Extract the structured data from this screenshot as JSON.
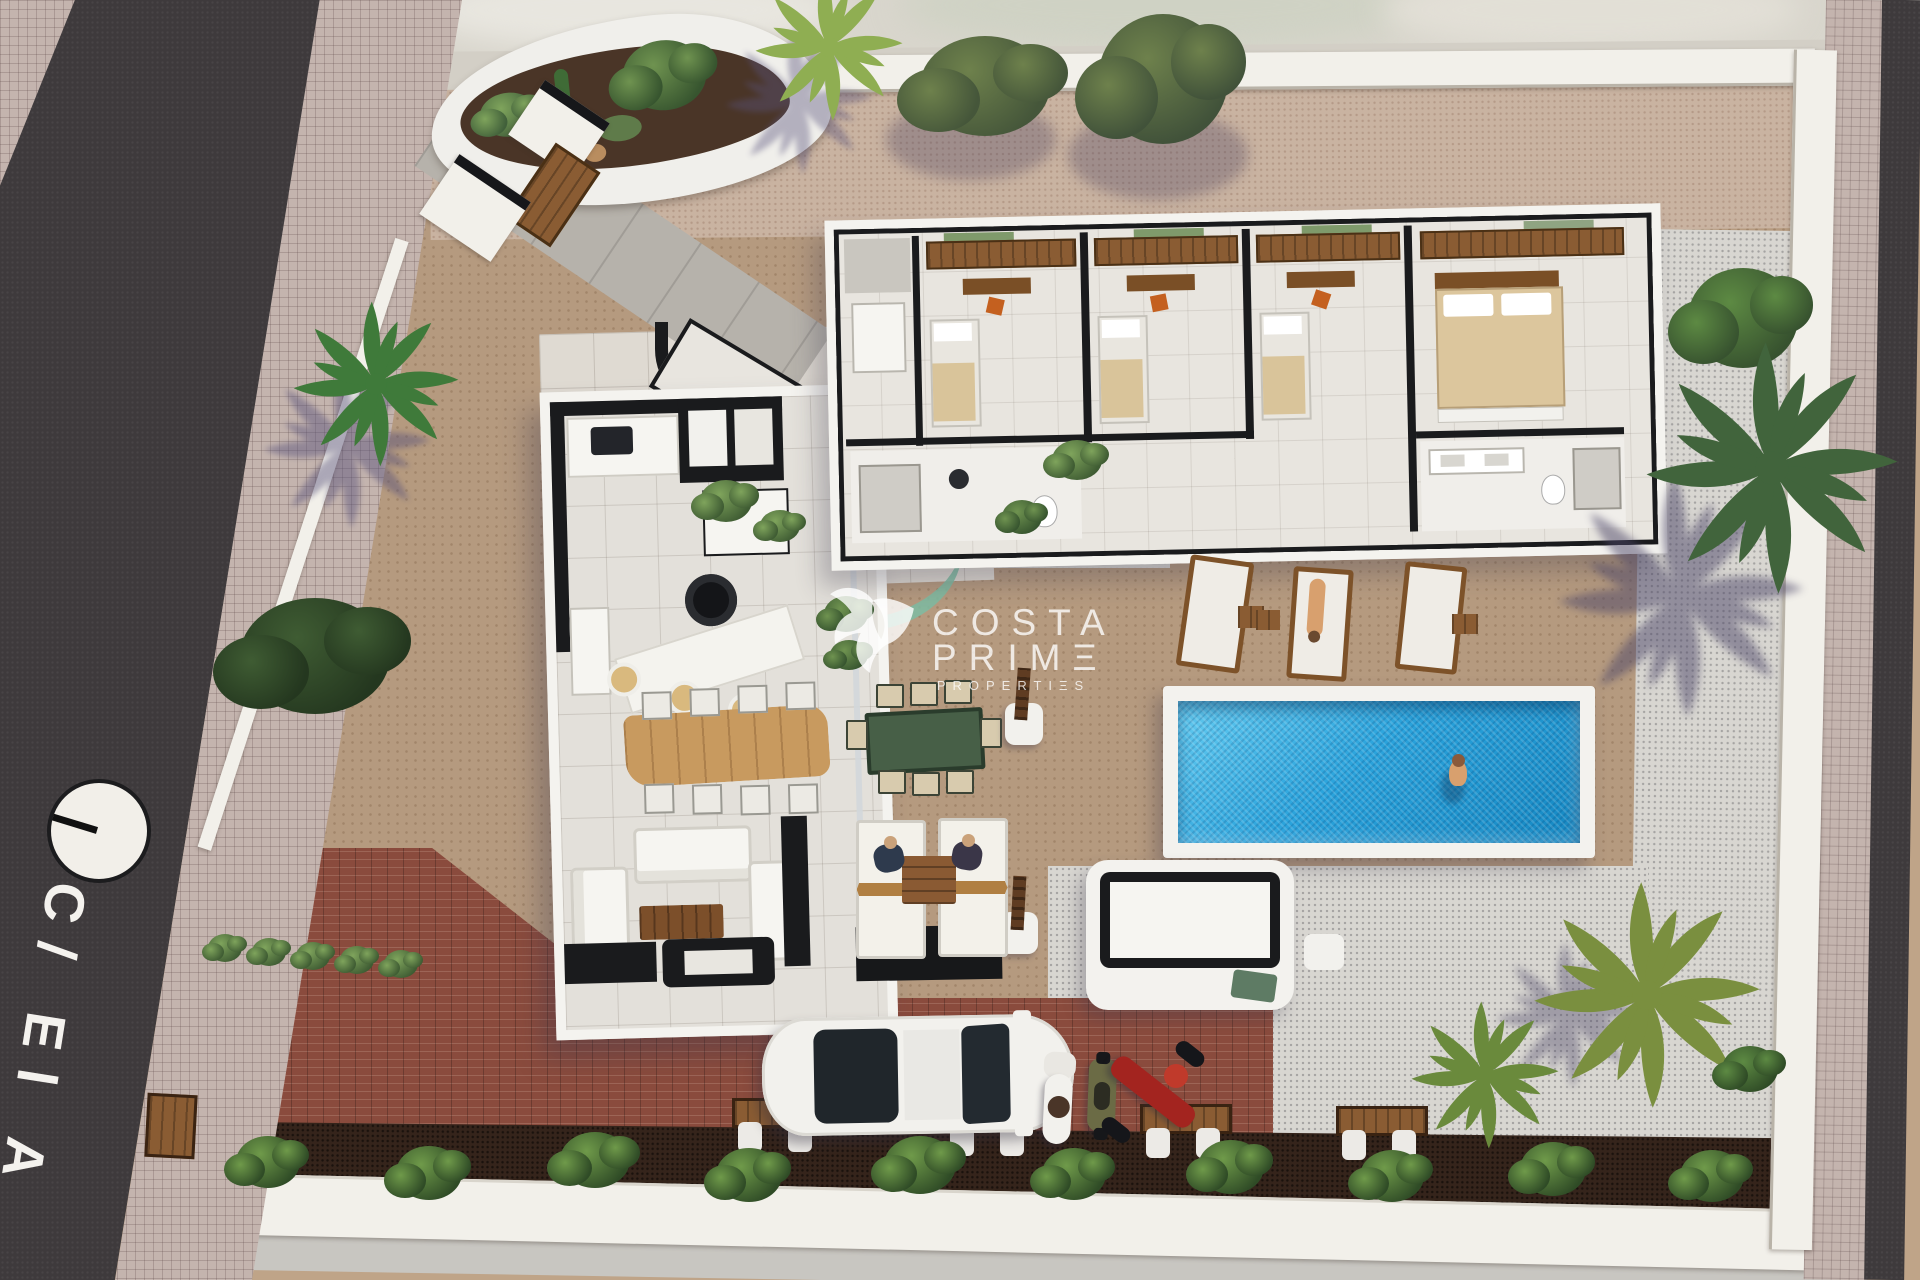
{
  "scene": {
    "description": "Aerial 3D architectural render of a villa plot: open-top floor plan villa, swimming pool with swimmer, terraces, sun loungers, driveway with car and motorbikes, palm trees and street",
    "street": {
      "label": "C/ El A"
    },
    "watermark": {
      "logo_icon": "hummingbird-logo",
      "line1": "COSTA",
      "line2": "PRIMΞ",
      "line3": "PROPERTIΞS"
    },
    "palette": {
      "road": "#3e3a3c",
      "sidewalk": "#c4b4ae",
      "plot_cobble": "#b59a7f",
      "top_gravel": "#c9b3a1",
      "white_gravel": "#d8d6d1",
      "terrace_tile": "#dfdad2",
      "brick_driveway": "#8a4b3d",
      "planting_soil": "#35241b",
      "wall_white": "#f2f0ea",
      "wall_black": "#1a1b1d",
      "pool_water": "#2da0d8",
      "palm_green": "#41643c",
      "wood": "#8a5c33",
      "bed_beige": "#dcc69d",
      "chair_orange": "#c4601f",
      "outdoor_table_green": "#475f47"
    }
  }
}
